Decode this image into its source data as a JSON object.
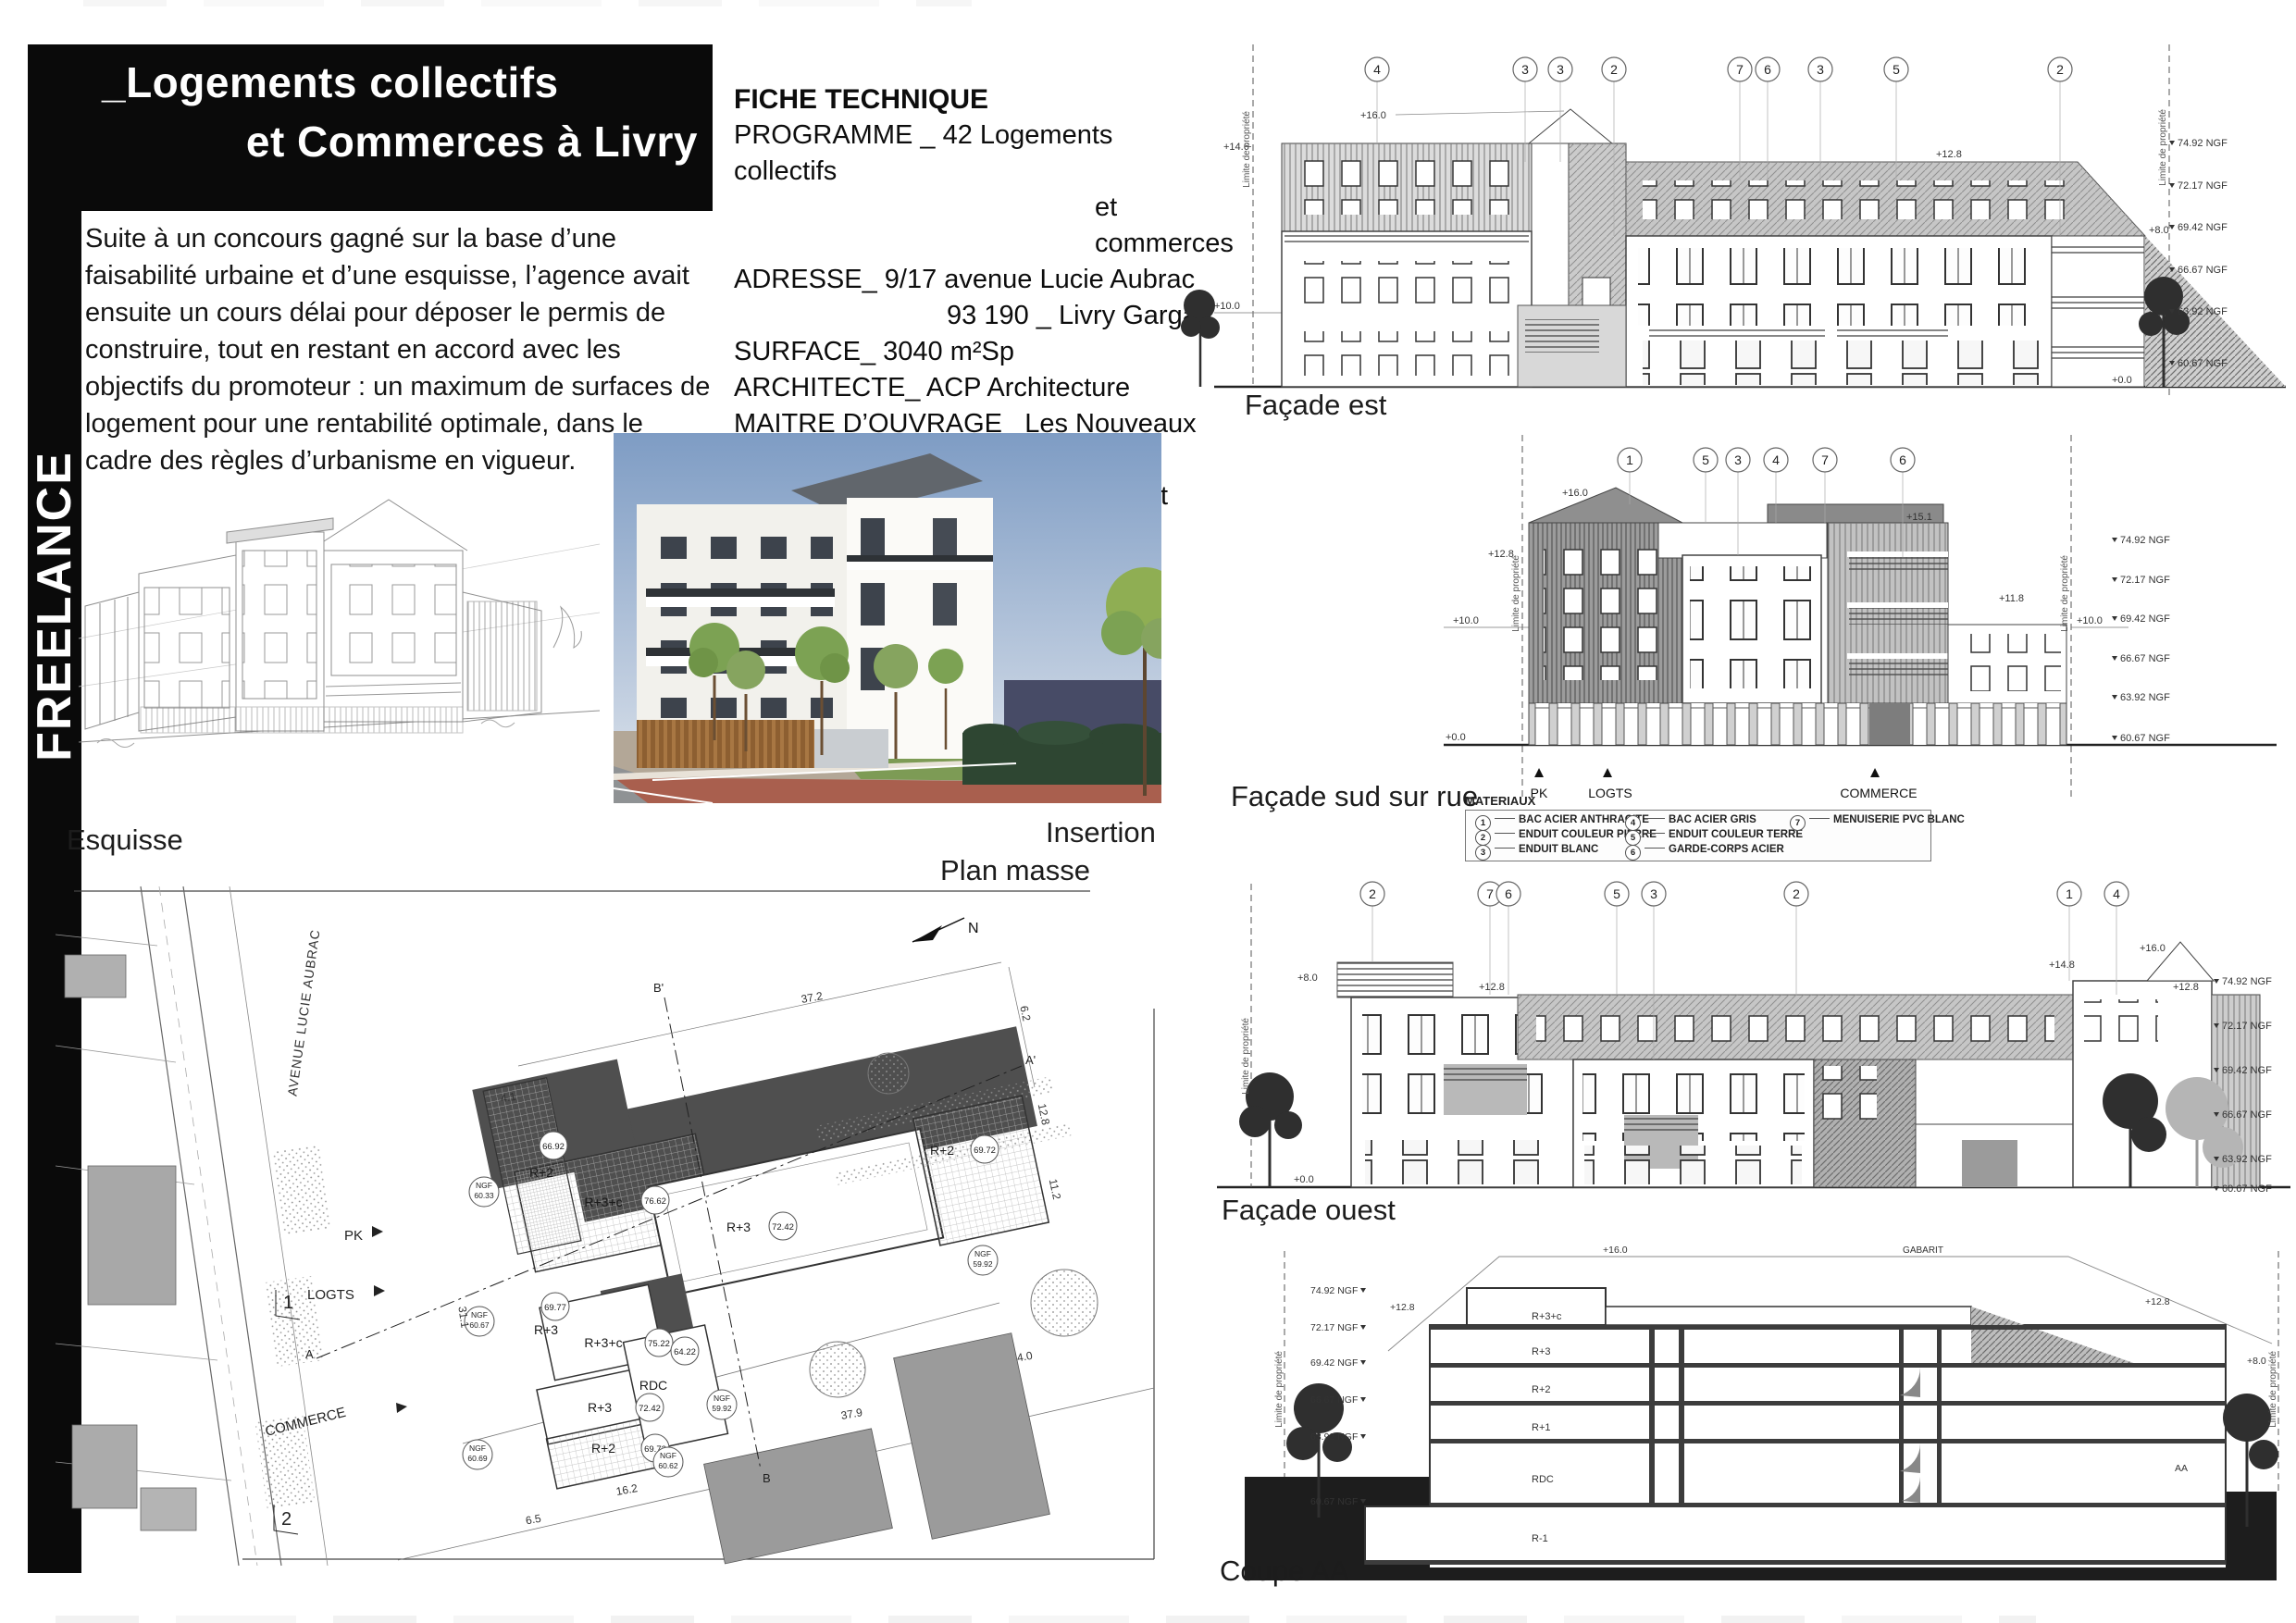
{
  "sidebar": {
    "label": "FREELANCE"
  },
  "title": {
    "line1": "_Logements collectifs",
    "line2": "et Commerces à Livry"
  },
  "intro": {
    "text": "Suite à un concours gagné sur la base d’une faisabilité urbaine et d’une esquisse, l’agence avait ensuite un cours délai pour déposer le permis de construire, tout en restant en accord avec les objectifs du promoteur : un maximum de surfaces de logement pour une rentabilité optimale, dans le cadre des règles d’urbanisme en vigueur."
  },
  "fiche": {
    "heading": "FICHE TECHNIQUE",
    "rows": [
      {
        "t": "PROGRAMME _ 42 Logements collectifs"
      },
      {
        "t": "et commerces"
      },
      {
        "t": "ADRESSE_ 9/17 avenue Lucie Aubrac"
      },
      {
        "t": "93 190 _ Livry Gargan"
      },
      {
        "t": "SURFACE_ 3040 m²Sp"
      },
      {
        "t": "ARCHITECTE_ ACP Architecture"
      },
      {
        "t": "MAITRE D’OUVRAGE_ Les Nouveaux Constructeurs"
      },
      {
        "t": "CALENDRIER_ PC  déposé en juillet 2016"
      }
    ]
  },
  "captions": {
    "esquisse": "Esquisse",
    "insertion": "Insertion",
    "plan": "Plan masse"
  },
  "materials": {
    "heading": "MATERIAUX",
    "items": [
      {
        "n": "1",
        "label": "BAC ACIER ANTHRACITE"
      },
      {
        "n": "2",
        "label": "ENDUIT COULEUR PIERRE"
      },
      {
        "n": "3",
        "label": "ENDUIT BLANC"
      },
      {
        "n": "4",
        "label": "BAC ACIER GRIS"
      },
      {
        "n": "5",
        "label": "ENDUIT COULEUR TERRE"
      },
      {
        "n": "6",
        "label": "GARDE-CORPS ACIER"
      },
      {
        "n": "7",
        "label": "MENUISERIE PVC BLANC"
      }
    ]
  },
  "drawings": {
    "limite": "Limite de propriété",
    "ngf_levels": [
      "74.92 NGF",
      "72.17 NGF",
      "69.42 NGF",
      "66.67 NGF",
      "63.92 NGF",
      "60.67 NGF"
    ],
    "est": {
      "label": "Façade est",
      "bubbles": [
        "4",
        "3",
        "3",
        "2",
        "7",
        "6",
        "3",
        "5",
        "2"
      ],
      "marks": {
        "m146": "+14.6",
        "m160": "+16.0",
        "m100": "+10.0",
        "m128": "+12.8",
        "m80": "+8.0",
        "m00": "+0.0"
      }
    },
    "sud": {
      "label": "Façade sud sur rue",
      "bubbles": [
        "1",
        "5",
        "3",
        "4",
        "7",
        "6"
      ],
      "marks": {
        "m160": "+16.0",
        "m128": "+12.8",
        "m100l": "+10.0",
        "m151": "+15.1",
        "m118": "+11.8",
        "m100r": "+10.0",
        "m00": "+0.0"
      },
      "ground_markers": [
        "PK",
        "LOGTS",
        "COMMERCE"
      ],
      "tri": "▲"
    },
    "ouest": {
      "label": "Façade ouest",
      "bubbles": [
        "2",
        "7",
        "6",
        "5",
        "3",
        "2",
        "1",
        "4"
      ],
      "marks": {
        "m128l": "+12.8",
        "m80": "+8.0",
        "m148": "+14.8",
        "m160": "+16.0",
        "m128r": "+12.8",
        "m00": "+0.0"
      }
    },
    "coupe": {
      "label": "Coupe AA",
      "gabarit": "GABARIT",
      "floors": [
        "R+3+c",
        "R+3",
        "R+2",
        "R+1",
        "RDC",
        "R-1"
      ],
      "marks": {
        "m128l": "+12.8",
        "m160": "+16.0",
        "m128r": "+12.8",
        "m80": "+8.0",
        "aa": "AA"
      }
    }
  },
  "plan": {
    "avenue": "AVENUE LUCIE AUBRAC",
    "north": "N",
    "arrows": [
      "PK",
      "LOGTS",
      "COMMERCE"
    ],
    "sections": {
      "s1": "1",
      "s2": "2",
      "a": "A",
      "a2": "A'",
      "b": "B",
      "b2": "B'"
    },
    "ngf_label": "NGF",
    "roofs": [
      {
        "name": "R+2",
        "val": "66.92"
      },
      {
        "name": "R+3+c",
        "val": "76.62"
      },
      {
        "name": "R+3",
        "val": "72.42"
      },
      {
        "name": "R+2",
        "val": "69.72"
      },
      {
        "name": "R+3",
        "val": "69.77"
      },
      {
        "name": "R+3+c",
        "val": "75.22"
      },
      {
        "name": "R+3",
        "val": "72.42"
      },
      {
        "name": "R+2",
        "val": "69.72"
      },
      {
        "name": "RDC",
        "val": "64.22"
      }
    ],
    "ngf_spots": [
      "60.33",
      "60.67",
      "60.69",
      "60.62",
      "59.92",
      "59.92"
    ],
    "dims": [
      "4.1",
      "37.2",
      "6.2",
      "12.8",
      "11.2",
      "4.0",
      "37.9",
      "16.2",
      "6.5",
      "31.1"
    ]
  }
}
